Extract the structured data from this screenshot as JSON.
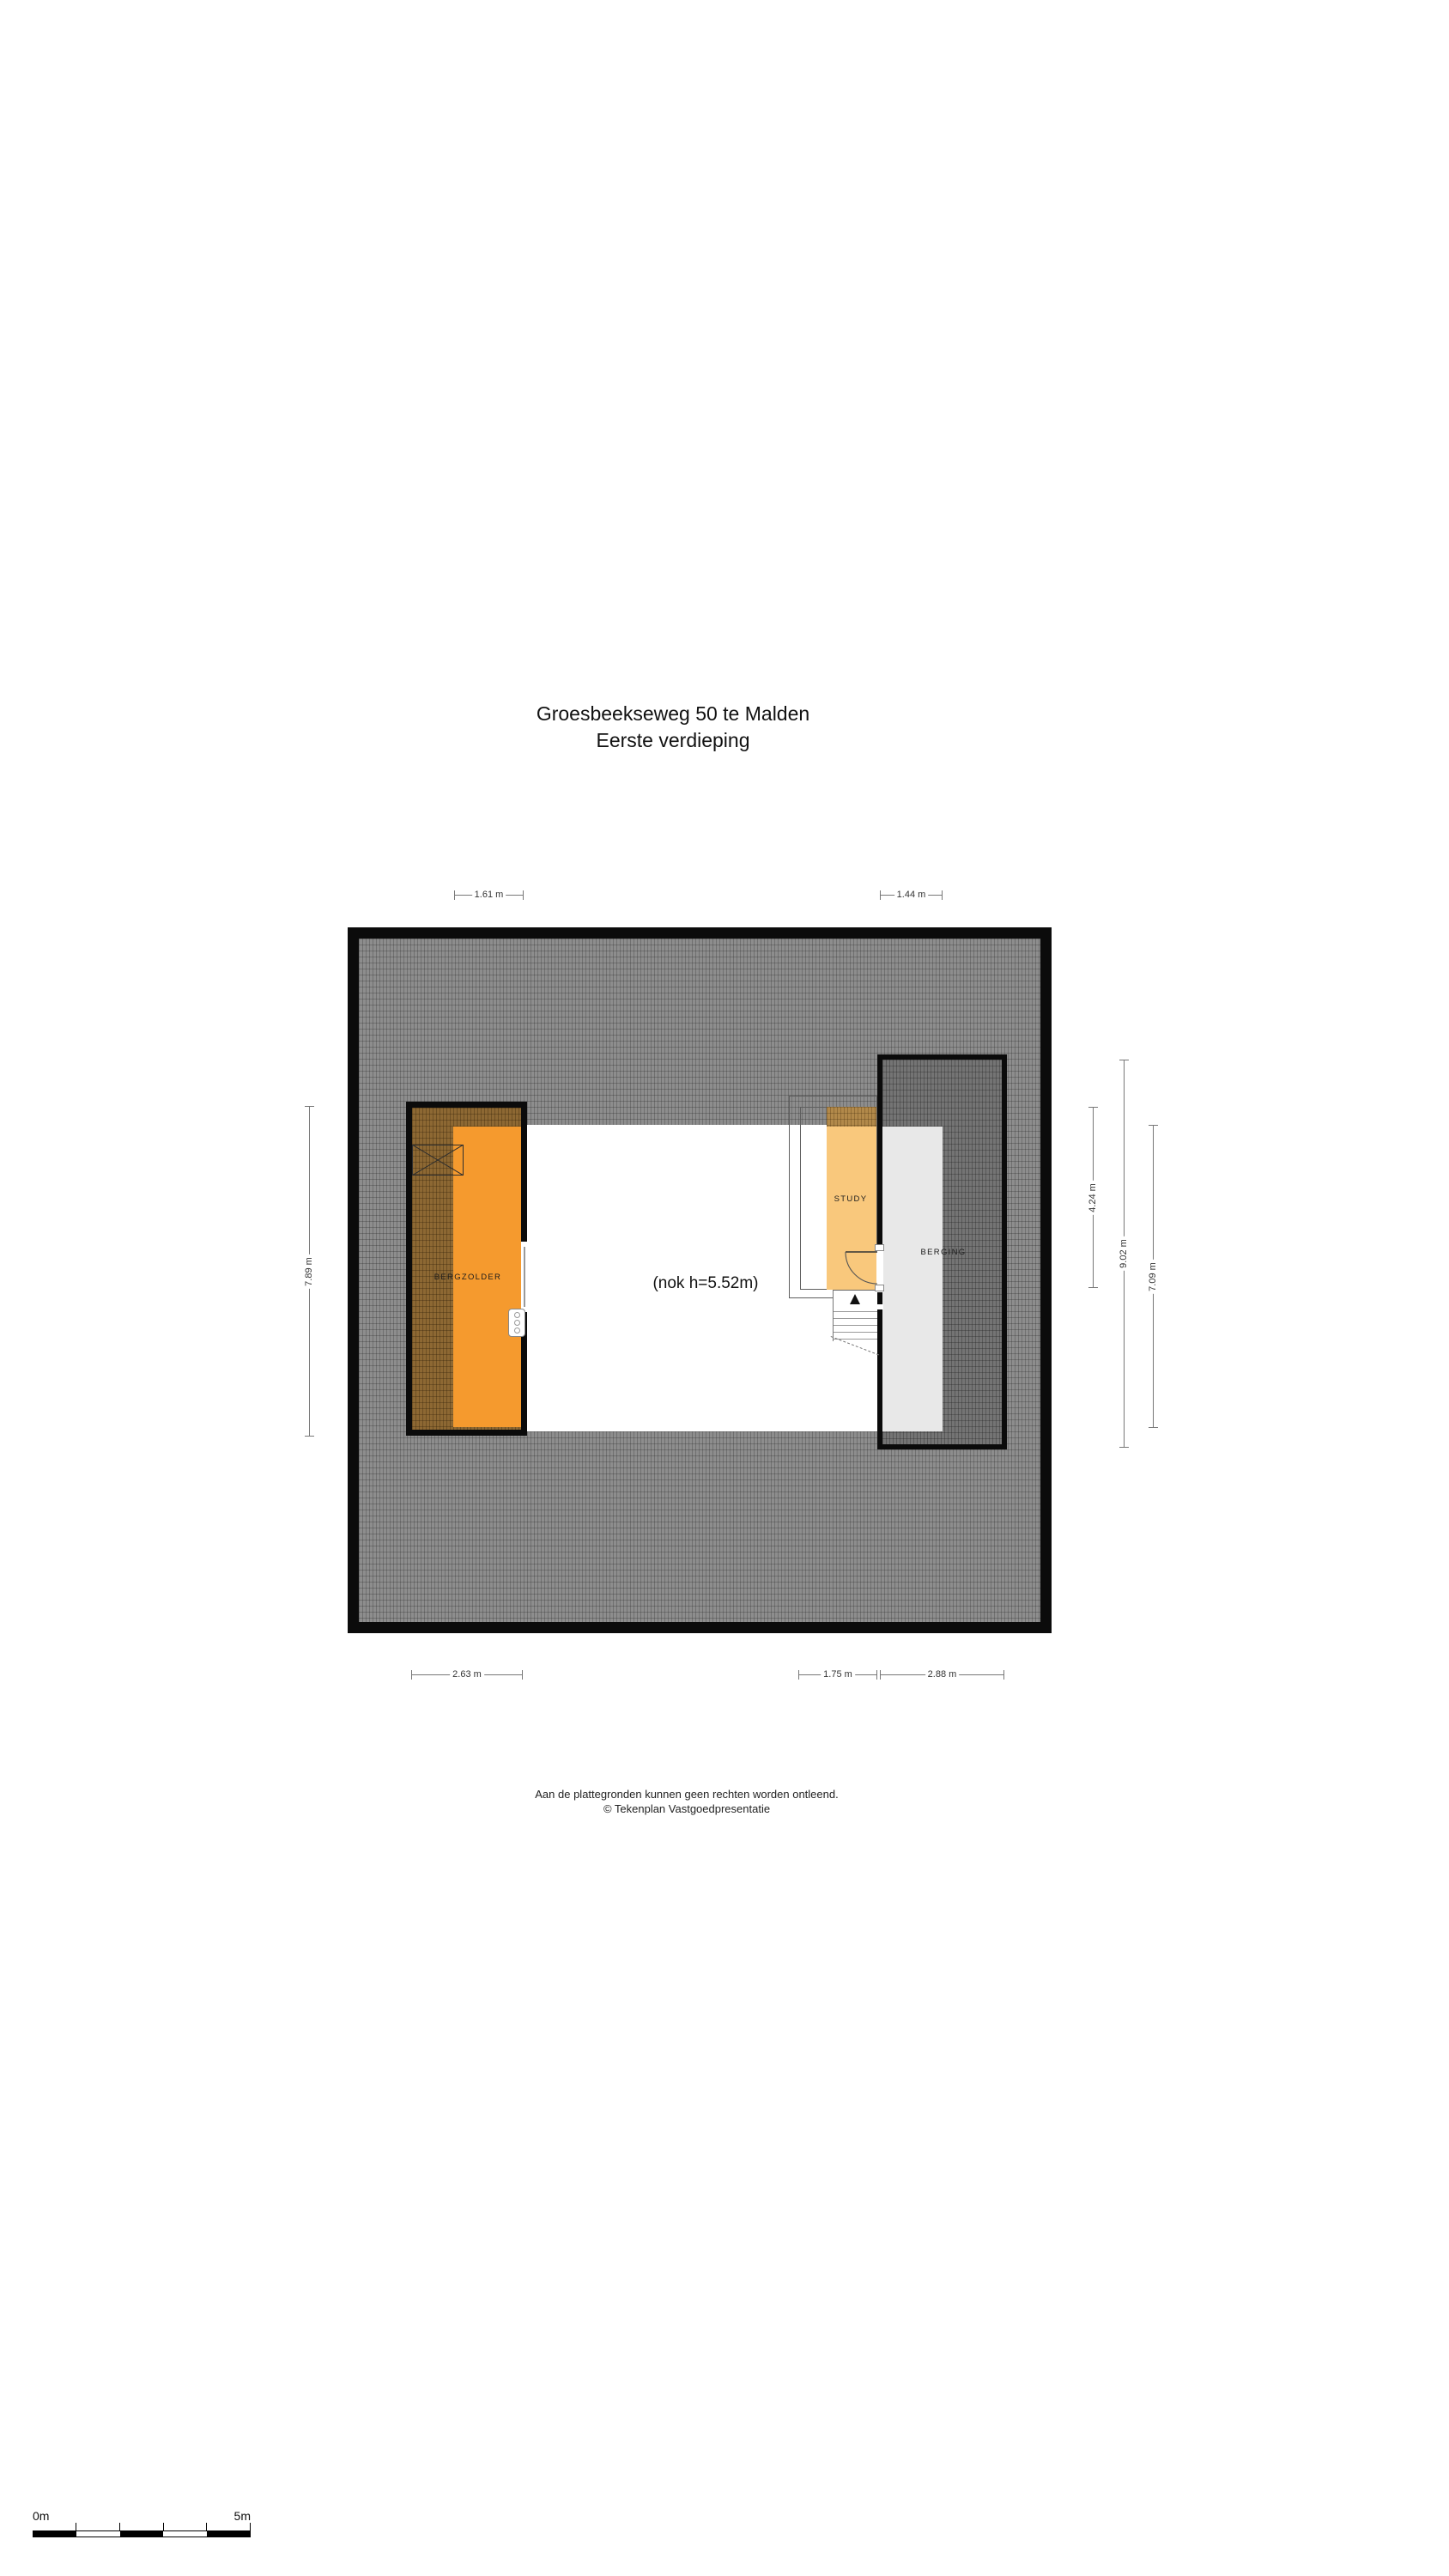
{
  "page": {
    "title_line1": "Groesbeekseweg 50 te Malden",
    "title_line2": "Eerste verdieping"
  },
  "plan": {
    "rooms": [
      {
        "label": "BERGZOLDER"
      },
      {
        "label": "STUDY"
      },
      {
        "label": "BERGING"
      }
    ],
    "annotation_nok": "(nok h=5.52m)"
  },
  "dimensions": {
    "top": [
      {
        "label": "1.61 m"
      },
      {
        "label": "1.44 m"
      }
    ],
    "bottom": [
      {
        "label": "2.63 m"
      },
      {
        "label": "1.75 m"
      },
      {
        "label": "2.88 m"
      }
    ],
    "left": [
      {
        "label": "7.89 m"
      }
    ],
    "right": [
      {
        "label": "4.24 m"
      },
      {
        "label": "9.02 m"
      },
      {
        "label": "7.09 m"
      }
    ]
  },
  "footer": {
    "line1": "Aan de plattegronden kunnen geen rechten worden ontleend.",
    "line2": "© Tekenplan Vastgoedpresentatie"
  },
  "scalebar": {
    "start_label": "0m",
    "end_label": "5m"
  },
  "colors": {
    "wall_black": "#0b0b0b",
    "roof_hatch_gray": "#8d8d8d",
    "annex_hatch_dark": "#747474",
    "bergzolder_orange": "#f59a2e",
    "study_orange": "#f9c87c",
    "berging_gray": "#e8e8e8",
    "dimension_line": "#777777"
  }
}
